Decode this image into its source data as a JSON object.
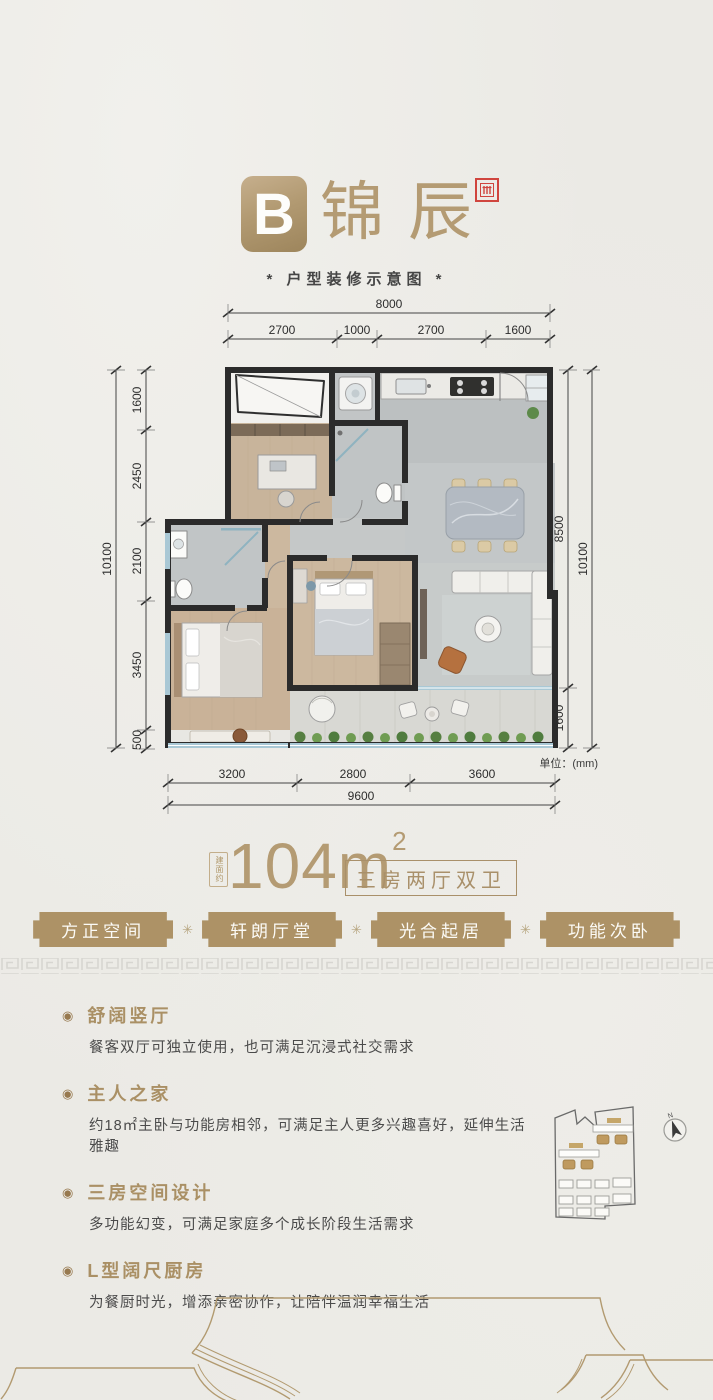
{
  "colors": {
    "accent_gold": "#ab9168",
    "gold_light": "#b49b73",
    "tag_background": "#ad9266",
    "seal_red": "#d0453e",
    "wall_dark": "#2b2b2b",
    "body_text": "#4b4b4b",
    "paper": "#ebeae5"
  },
  "header": {
    "badge": "B",
    "title": "锦辰",
    "subtitle": "* 户型装修示意图 *"
  },
  "floorplan": {
    "unit_note": "单位：(mm)",
    "dims": {
      "top_total": "8000",
      "top_segments": [
        "2700",
        "1000",
        "2700",
        "1600"
      ],
      "left_total": "10100",
      "left_segments": [
        "1600",
        "2450",
        "2100",
        "3450",
        "500"
      ],
      "right_segments": [
        "8500",
        "1600"
      ],
      "right_total": "10100",
      "bottom_segments": [
        "3200",
        "2800",
        "3600"
      ],
      "bottom_total": "9600"
    }
  },
  "area": {
    "prefix": "建面约",
    "value": "104m",
    "sup": "2",
    "type_box": "三房两厅双卫"
  },
  "tags": {
    "separator": "✳",
    "items": [
      "方正空间",
      "轩朗厅堂",
      "光合起居",
      "功能次卧"
    ]
  },
  "features": [
    {
      "title": "舒阔竖厅",
      "desc": "餐客双厅可独立使用，也可满足沉浸式社交需求"
    },
    {
      "title": "主人之家",
      "desc": "约18㎡主卧与功能房相邻，可满足主人更多兴趣喜好，延伸生活雅趣"
    },
    {
      "title": "三房空间设计",
      "desc": "多功能幻变，可满足家庭多个成长阶段生活需求"
    },
    {
      "title": "L型阔尺厨房",
      "desc": "为餐厨时光，增添亲密协作，让陪伴温润幸福生活"
    }
  ],
  "siteplan": {
    "north": "N"
  }
}
